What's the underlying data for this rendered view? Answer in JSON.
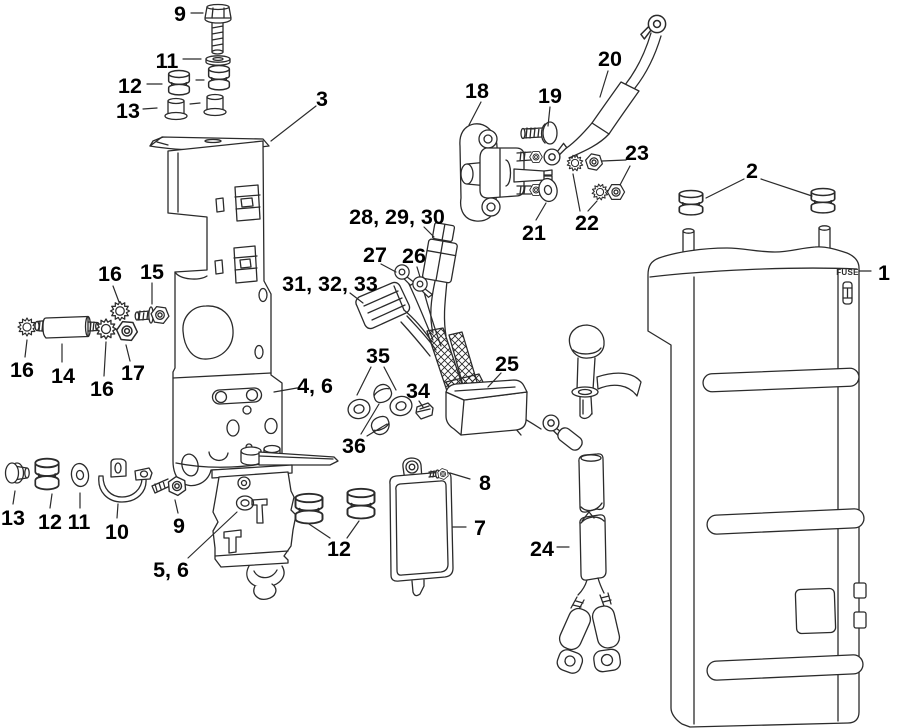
{
  "fuse_label": "FUSE",
  "colors": {
    "line": "#2b2b2b",
    "background": "#ffffff",
    "label": "#000000"
  },
  "callouts": {
    "c1": {
      "label": "1"
    },
    "c2": {
      "label": "2"
    },
    "c3": {
      "label": "3"
    },
    "c4_6": {
      "label": "4, 6"
    },
    "c5_6": {
      "label": "5, 6"
    },
    "c7": {
      "label": "7"
    },
    "c8": {
      "label": "8"
    },
    "c9_top": {
      "label": "9"
    },
    "c9_bottom": {
      "label": "9"
    },
    "c10": {
      "label": "10"
    },
    "c11_top": {
      "label": "11"
    },
    "c11_bottom": {
      "label": "11"
    },
    "c12_top": {
      "label": "12"
    },
    "c12_bottom": {
      "label": "12"
    },
    "c12_middle": {
      "label": "12"
    },
    "c13_top": {
      "label": "13"
    },
    "c13_bottom": {
      "label": "13"
    },
    "c14": {
      "label": "14"
    },
    "c15": {
      "label": "15"
    },
    "c16_upper": {
      "label": "16"
    },
    "c16_left": {
      "label": "16"
    },
    "c16_middle": {
      "label": "16"
    },
    "c17": {
      "label": "17"
    },
    "c18": {
      "label": "18"
    },
    "c19": {
      "label": "19"
    },
    "c20": {
      "label": "20"
    },
    "c21": {
      "label": "21"
    },
    "c22": {
      "label": "22"
    },
    "c23": {
      "label": "23"
    },
    "c24": {
      "label": "24"
    },
    "c25": {
      "label": "25"
    },
    "c26": {
      "label": "26"
    },
    "c27": {
      "label": "27"
    },
    "c28_29_30": {
      "label": "28, 29, 30"
    },
    "c31_32_33": {
      "label": "31, 32, 33"
    },
    "c34": {
      "label": "34"
    },
    "c35": {
      "label": "35"
    },
    "c36": {
      "label": "36"
    }
  }
}
